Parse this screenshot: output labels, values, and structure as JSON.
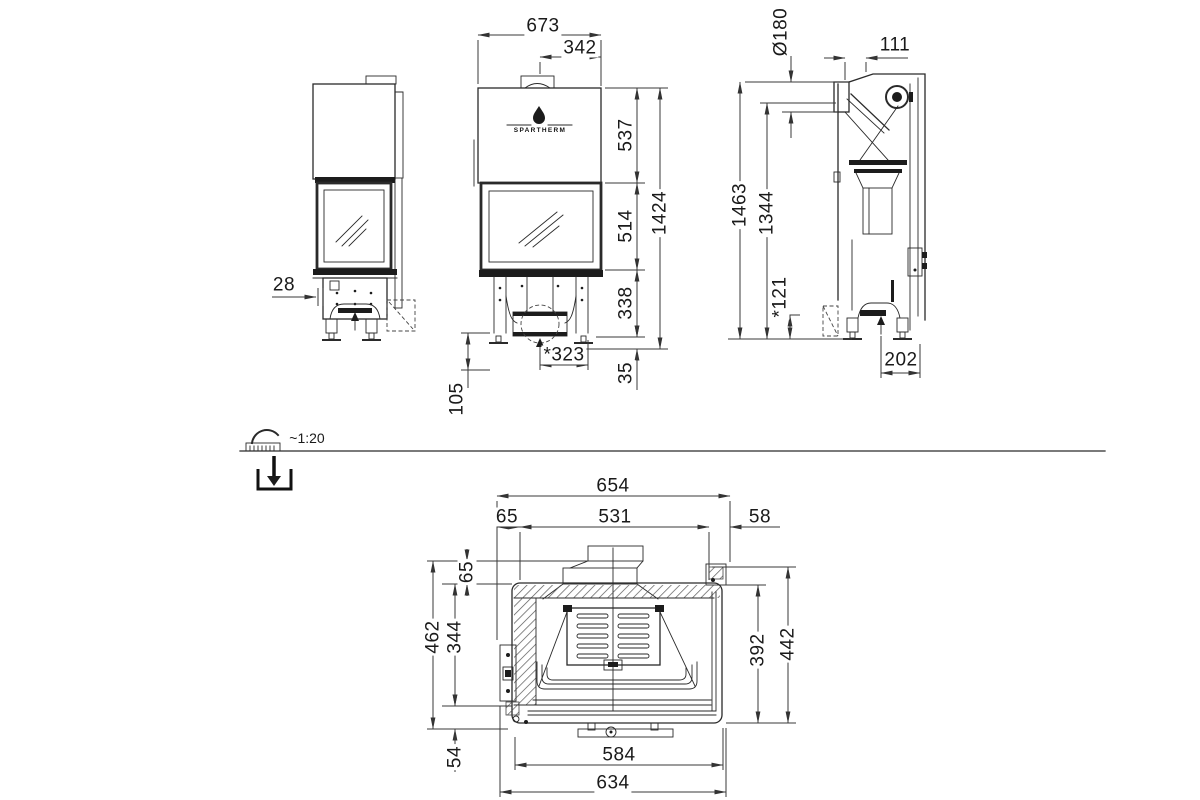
{
  "brand": {
    "logo_text": "SPARTHERM"
  },
  "scale": {
    "label": "~1:20"
  },
  "left_view": {
    "front_recess": "28"
  },
  "front_view": {
    "width": "673",
    "flue_offset": "342",
    "hood_height": "537",
    "glass_height": "514",
    "base_height": "338",
    "feet_height": "35",
    "total_height": "1424",
    "air_inlet_offset": "*323",
    "ground_clearance": "105"
  },
  "right_view": {
    "flue_diameter": "Ø180",
    "flue_front_offset": "111",
    "total_height": "1463",
    "body_height": "1344",
    "base_detail": "*121",
    "foot_spacing": "202"
  },
  "plan_view": {
    "outer_width": "654",
    "left_offset": "65",
    "glass_width": "531",
    "right_offset": "58",
    "collar_depth": "65",
    "inner_depth": "344",
    "outer_depth": "462",
    "front_depth": "54",
    "glass_depth": "392",
    "right_depth": "442",
    "door_width": "584",
    "front_width": "634"
  }
}
